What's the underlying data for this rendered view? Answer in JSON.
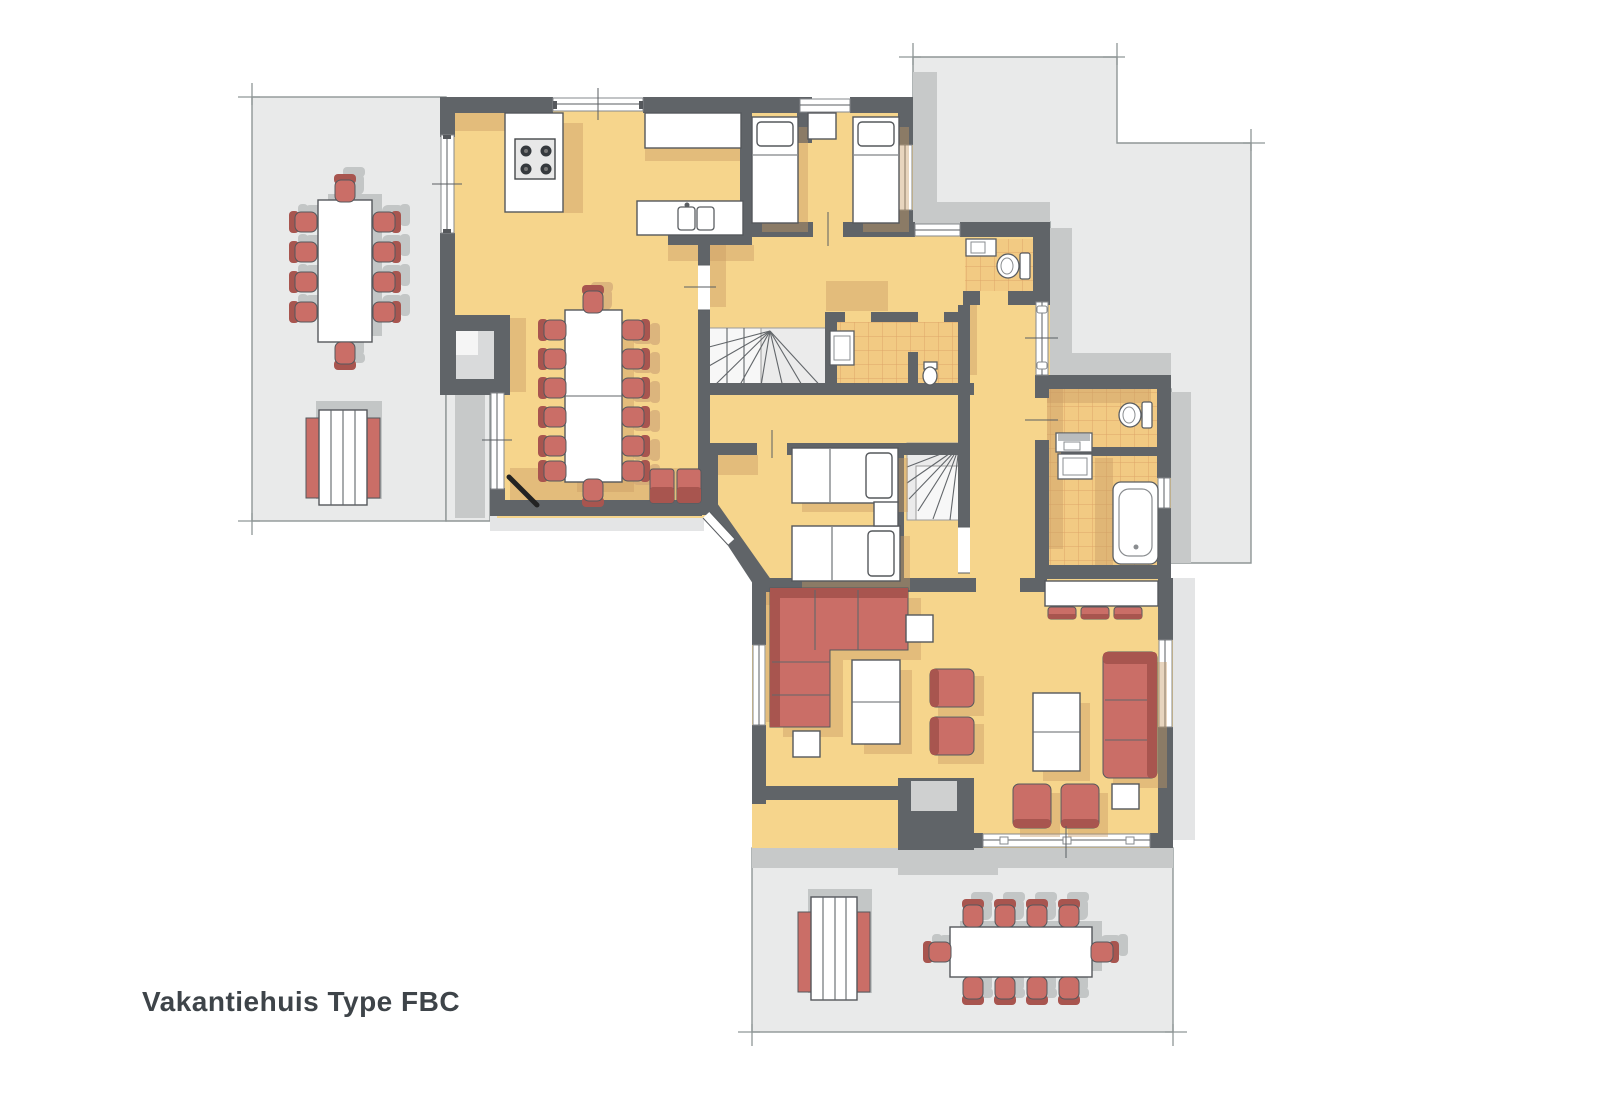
{
  "title": {
    "label": "Vakantiehuis Type FBC"
  },
  "palette": {
    "background": "#ffffff",
    "floor": "#f6d58c",
    "floorShadow": "#c89a63",
    "wall": "#606468",
    "terrace": "#e9eaea",
    "terraceShadow": "#c7c9c9",
    "terraceLine": "#8f9696",
    "outline": "#55585c",
    "red": "#ca6e67",
    "redDark": "#a8554f",
    "ghost": "#c3c6c6",
    "tileFloor": "#f2ca83",
    "tileLine": "#dc9f63",
    "stairFill": "#ebebeb",
    "titleColor": "#3e4449"
  }
}
